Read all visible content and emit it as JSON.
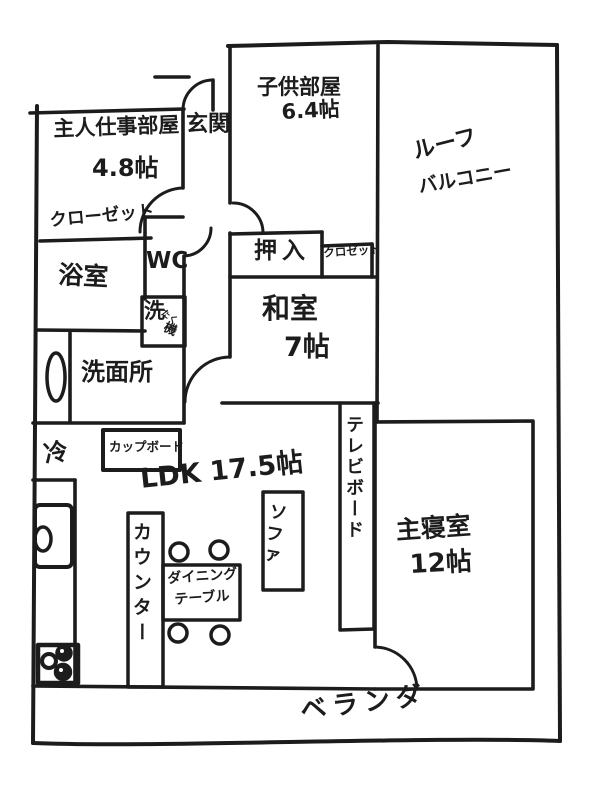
{
  "page": {
    "background": "#ffffff",
    "ink_color": "#1c1c1c"
  },
  "floorplan": {
    "rooms": {
      "master_work_room": {
        "name": "主人仕事部屋",
        "size": "4.8帖"
      },
      "entrance": {
        "name": "玄関"
      },
      "kids_room": {
        "name": "子供部屋",
        "size": "6.4帖"
      },
      "roof_balcony": {
        "name_line1": "ルーフ",
        "name_line2": "バルコニー"
      },
      "closet_main": {
        "name": "クローゼット"
      },
      "bathroom": {
        "name": "浴室"
      },
      "toilet": {
        "name": "WC"
      },
      "oshiire": {
        "name": "押入"
      },
      "closet_washitsu": {
        "name": "クロゼット"
      },
      "washitsu": {
        "name": "和室",
        "size": "7帖"
      },
      "washroom": {
        "name": "洗面所"
      },
      "ldk": {
        "name": "LDK 17.5帖"
      },
      "master_bedroom": {
        "name": "主寝室",
        "size": "12帖"
      },
      "veranda": {
        "name": "ベランダ"
      }
    },
    "fixtures": {
      "washing_machine": {
        "kanji_main": "洗",
        "kana": "たく",
        "kanji_sub": "機"
      },
      "refrigerator": {
        "name": "冷"
      },
      "cupboard": {
        "name": "カップボード"
      },
      "counter": {
        "name": "カウンター"
      },
      "dining_table": {
        "name_line1": "ダイニング",
        "name_line2": "テーブル"
      },
      "sofa": {
        "name": "ソファ"
      },
      "tv_board": {
        "name": "テレビボード"
      }
    }
  }
}
